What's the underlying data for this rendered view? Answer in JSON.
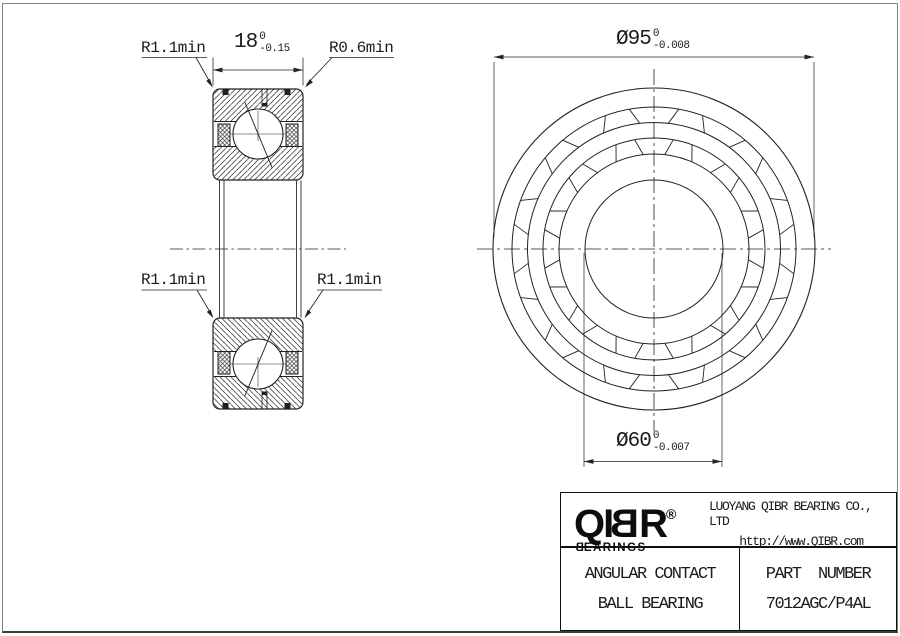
{
  "colors": {
    "ink": "#222222",
    "text": "#1b1b1b",
    "frame": "#828282"
  },
  "section_view": {
    "fillet_top_left": "R1.1min",
    "fillet_top_right": "R0.6min",
    "fillet_mid_left": "R1.1min",
    "fillet_mid_right": "R1.1min",
    "width_dim": {
      "nominal": "18",
      "tol_upper": "0",
      "tol_lower": "-0.15"
    }
  },
  "front_view": {
    "outer_diameter": {
      "nominal": "Ø95",
      "tol_upper": "0",
      "tol_lower": "-0.008"
    },
    "bore_diameter": {
      "nominal": "Ø60",
      "tol_upper": "0",
      "tol_lower": "-0.007"
    }
  },
  "title_block": {
    "logo_prefix": "QI",
    "logo_mirrored_b": "B",
    "logo_suffix": "R",
    "logo_registered": "®",
    "logo_sub_mirrored_b": "B",
    "logo_sub_rest": "EARINGS",
    "company": "LUOYANG QIBR BEARING CO., LTD",
    "website": "http://www.QIBR.com",
    "product_line1": "ANGULAR CONTACT",
    "product_line2": "BALL BEARING",
    "part_label": "PART  NUMBER",
    "part_number": "7012AGC/P4AL"
  }
}
